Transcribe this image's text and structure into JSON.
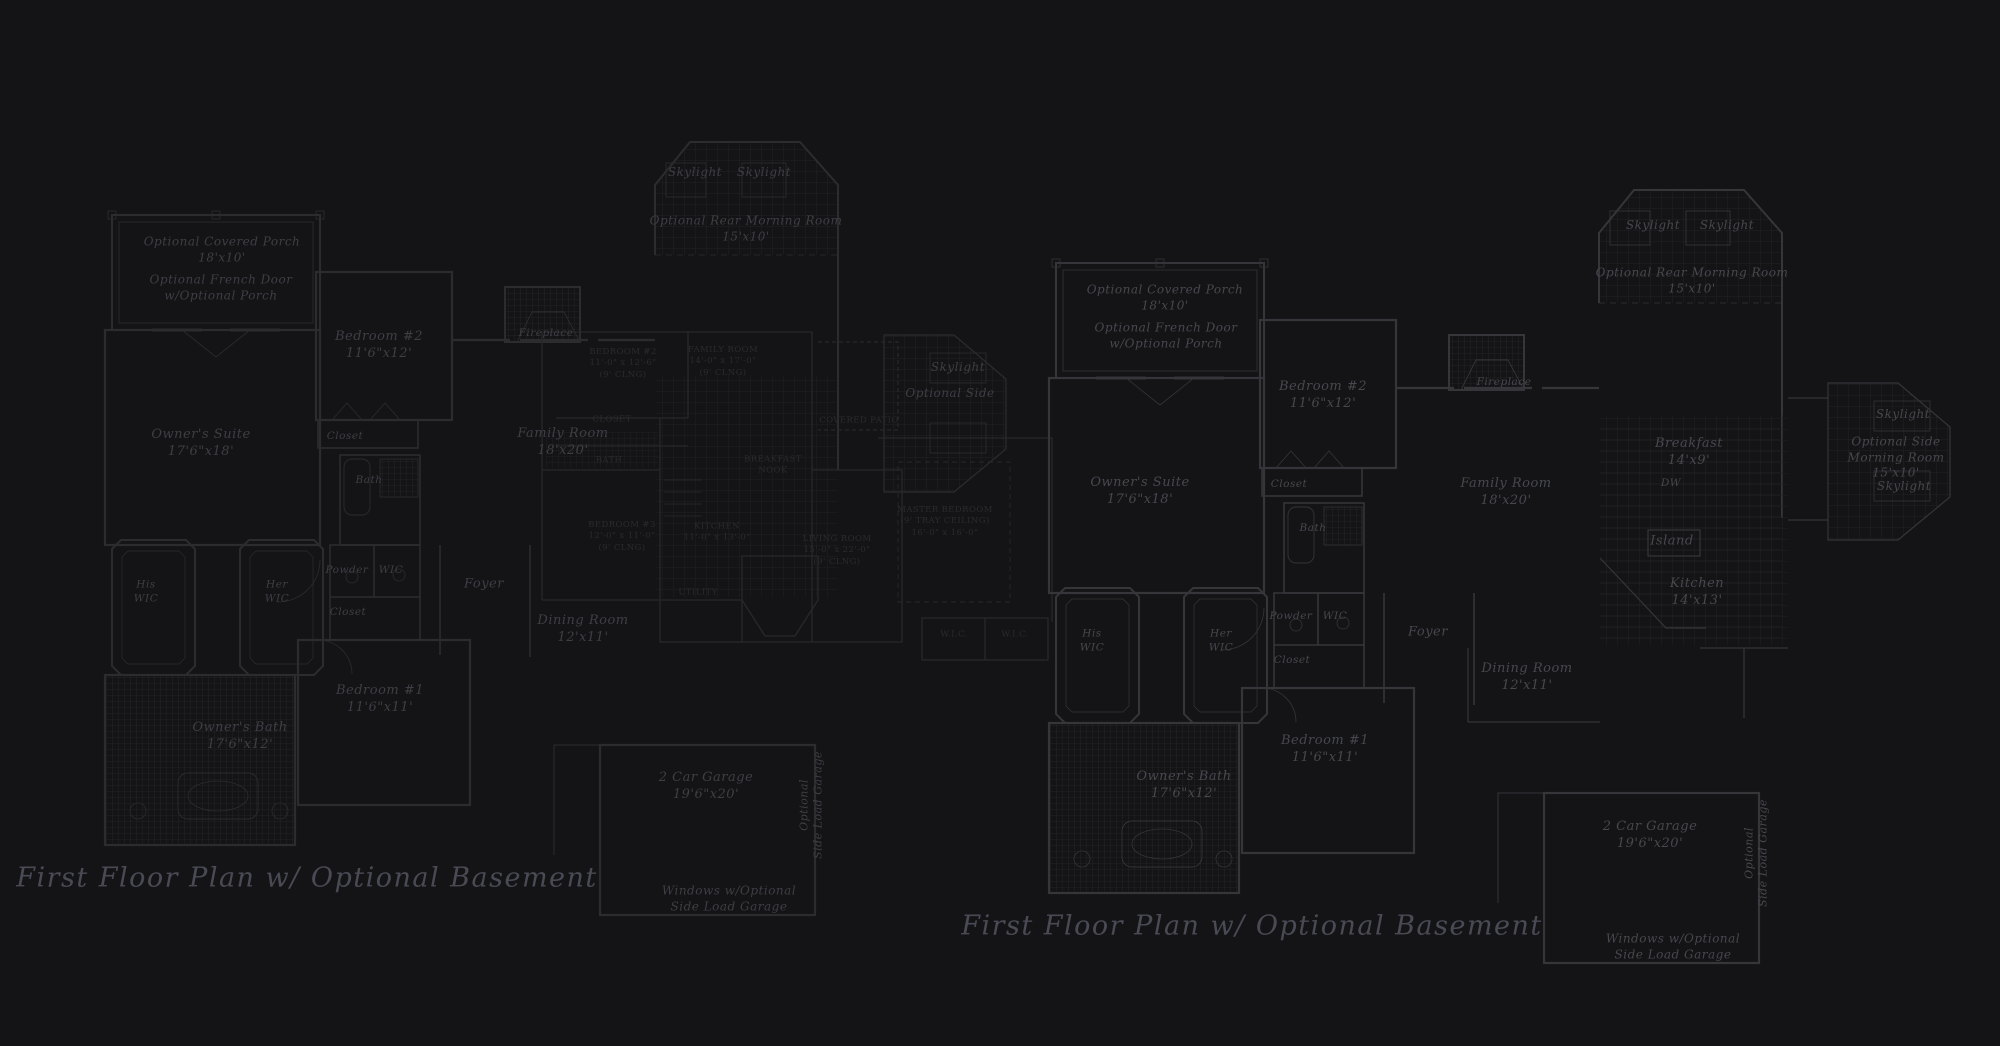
{
  "page": {
    "background": "#141416",
    "wall_color_left": "#2c2c2f",
    "wall_color_right": "#35353a",
    "overlay_wall_color": "#28282b",
    "grid_color": "#232327",
    "text_color_left": "#3e3e46",
    "text_color_right": "#47474f",
    "overlay_text_color": "#2b2b2f",
    "title_color": "#4a4a55"
  },
  "drawing_titles": {
    "left": "First Floor Plan  w/ Optional Basement",
    "right": "First Floor Plan  w/ Optional Basement"
  },
  "labels": [
    {
      "name": "left-skylight-1",
      "text": "Skylight",
      "x": 695,
      "y": 173,
      "kind": "note",
      "tone": "left"
    },
    {
      "name": "left-skylight-2",
      "text": "Skylight",
      "x": 764,
      "y": 173,
      "kind": "note",
      "tone": "left"
    },
    {
      "name": "left-rear-morning-room",
      "text": "Optional Rear Morning Room\n15'x10'",
      "x": 746,
      "y": 229,
      "kind": "note",
      "tone": "left"
    },
    {
      "name": "left-covered-porch",
      "text": "Optional Covered Porch\n18'x10'",
      "x": 222,
      "y": 250,
      "kind": "note",
      "tone": "left"
    },
    {
      "name": "left-french-door",
      "text": "Optional French Door\nw/Optional Porch",
      "x": 221,
      "y": 288,
      "kind": "note",
      "tone": "left"
    },
    {
      "name": "left-bedroom-2",
      "text": "Bedroom #2\n11'6\"x12'",
      "x": 379,
      "y": 346,
      "kind": "room",
      "tone": "left"
    },
    {
      "name": "left-closet-1",
      "text": "Closet",
      "x": 345,
      "y": 437,
      "kind": "small",
      "tone": "left"
    },
    {
      "name": "left-owners-suite",
      "text": "Owner's Suite\n17'6\"x18'",
      "x": 201,
      "y": 444,
      "kind": "room",
      "tone": "left"
    },
    {
      "name": "left-bath",
      "text": "Bath",
      "x": 369,
      "y": 481,
      "kind": "small",
      "tone": "left"
    },
    {
      "name": "left-fireplace",
      "text": "Fireplace",
      "x": 546,
      "y": 334,
      "kind": "small",
      "tone": "left"
    },
    {
      "name": "left-family-room",
      "text": "Family Room\n18'x20'",
      "x": 563,
      "y": 443,
      "kind": "room",
      "tone": "left"
    },
    {
      "name": "left-side-skylight",
      "text": "Skylight",
      "x": 958,
      "y": 368,
      "kind": "note",
      "tone": "left"
    },
    {
      "name": "left-side-morning-room",
      "text": "Optional Side",
      "x": 950,
      "y": 394,
      "kind": "note",
      "tone": "left"
    },
    {
      "name": "left-powder",
      "text": "Powder",
      "x": 347,
      "y": 571,
      "kind": "small",
      "tone": "left"
    },
    {
      "name": "left-wic",
      "text": "WIC",
      "x": 391,
      "y": 571,
      "kind": "small",
      "tone": "left"
    },
    {
      "name": "left-closet-2",
      "text": "Closet",
      "x": 348,
      "y": 613,
      "kind": "small",
      "tone": "left"
    },
    {
      "name": "left-his-wic",
      "text": "His\nWIC",
      "x": 146,
      "y": 592,
      "kind": "small",
      "tone": "left"
    },
    {
      "name": "left-her-wic",
      "text": "Her\nWIC",
      "x": 277,
      "y": 592,
      "kind": "small",
      "tone": "left"
    },
    {
      "name": "left-foyer",
      "text": "Foyer",
      "x": 484,
      "y": 585,
      "kind": "room",
      "tone": "left"
    },
    {
      "name": "left-dining-room",
      "text": "Dining Room\n12'x11'",
      "x": 583,
      "y": 630,
      "kind": "room",
      "tone": "left"
    },
    {
      "name": "left-bedroom-1",
      "text": "Bedroom #1\n11'6\"x11'",
      "x": 380,
      "y": 700,
      "kind": "room",
      "tone": "left"
    },
    {
      "name": "left-owners-bath",
      "text": "Owner's Bath\n17'6\"x12'",
      "x": 240,
      "y": 737,
      "kind": "room",
      "tone": "left"
    },
    {
      "name": "left-garage",
      "text": "2 Car Garage\n19'6\"x20'",
      "x": 706,
      "y": 787,
      "kind": "room",
      "tone": "left"
    },
    {
      "name": "left-side-load-garage",
      "text": "Optional\nSide Load Garage",
      "x": 812,
      "y": 805,
      "kind": "vert",
      "tone": "left"
    },
    {
      "name": "left-windows-note",
      "text": "Windows w/Optional\nSide Load Garage",
      "x": 729,
      "y": 899,
      "kind": "note",
      "tone": "left"
    },
    {
      "name": "left-plan-title",
      "text": "First Floor Plan  w/ Optional Basement",
      "x": 307,
      "y": 878,
      "kind": "title",
      "tone": "left"
    },
    {
      "name": "overlay-bedroom-2",
      "text": "BEDROOM #2\n11'-0\" x 12'-6\"\n(9' CLNG)",
      "x": 623,
      "y": 364,
      "kind": "caps",
      "tone": "overlay"
    },
    {
      "name": "overlay-family-room",
      "text": "FAMILY ROOM\n14'-0\" x 17'-0\"\n(9' CLNG)",
      "x": 723,
      "y": 362,
      "kind": "caps",
      "tone": "overlay"
    },
    {
      "name": "overlay-closet",
      "text": "CLOSET",
      "x": 612,
      "y": 420,
      "kind": "caps",
      "tone": "overlay"
    },
    {
      "name": "overlay-bath",
      "text": "BATH",
      "x": 609,
      "y": 461,
      "kind": "caps",
      "tone": "overlay"
    },
    {
      "name": "overlay-bedroom-3",
      "text": "BEDROOM #3\n12'-0\" x 11'-0\"\n(9' CLNG)",
      "x": 622,
      "y": 537,
      "kind": "caps",
      "tone": "overlay"
    },
    {
      "name": "overlay-kitchen",
      "text": "KITCHEN\n11'-0\" x 13'-0\"",
      "x": 717,
      "y": 533,
      "kind": "caps",
      "tone": "overlay"
    },
    {
      "name": "overlay-breakfast-nook",
      "text": "BREAKFAST\nNOOK",
      "x": 773,
      "y": 466,
      "kind": "caps",
      "tone": "overlay"
    },
    {
      "name": "overlay-utility",
      "text": "UTILITY",
      "x": 698,
      "y": 593,
      "kind": "caps",
      "tone": "overlay"
    },
    {
      "name": "overlay-living-room",
      "text": "LIVING ROOM\n15'-0\" x 22'-0\"\n(9' CLNG)",
      "x": 837,
      "y": 551,
      "kind": "caps",
      "tone": "overlay"
    },
    {
      "name": "overlay-covered-patio",
      "text": "COVERED PATIO",
      "x": 859,
      "y": 421,
      "kind": "caps",
      "tone": "overlay"
    },
    {
      "name": "overlay-master-bedroom",
      "text": "MASTER BEDROOM\n(9' TRAY CEILING)\n16'-0\" x 16'-0\"",
      "x": 945,
      "y": 522,
      "kind": "caps",
      "tone": "overlay"
    },
    {
      "name": "overlay-wic-1",
      "text": "W.I.C.",
      "x": 954,
      "y": 635,
      "kind": "caps",
      "tone": "overlay"
    },
    {
      "name": "overlay-wic-2",
      "text": "W.I.C.",
      "x": 1015,
      "y": 635,
      "kind": "caps",
      "tone": "overlay"
    },
    {
      "name": "right-skylight-1",
      "text": "Skylight",
      "x": 1653,
      "y": 226,
      "kind": "note",
      "tone": "right"
    },
    {
      "name": "right-skylight-2",
      "text": "Skylight",
      "x": 1727,
      "y": 226,
      "kind": "note",
      "tone": "right"
    },
    {
      "name": "right-rear-morning-room",
      "text": "Optional Rear Morning Room\n15'x10'",
      "x": 1692,
      "y": 281,
      "kind": "note",
      "tone": "right"
    },
    {
      "name": "right-covered-porch",
      "text": "Optional Covered Porch\n18'x10'",
      "x": 1165,
      "y": 298,
      "kind": "note",
      "tone": "right"
    },
    {
      "name": "right-french-door",
      "text": "Optional French Door\nw/Optional Porch",
      "x": 1166,
      "y": 336,
      "kind": "note",
      "tone": "right"
    },
    {
      "name": "right-bedroom-2",
      "text": "Bedroom #2\n11'6\"x12'",
      "x": 1323,
      "y": 396,
      "kind": "room",
      "tone": "right"
    },
    {
      "name": "right-closet-1",
      "text": "Closet",
      "x": 1289,
      "y": 485,
      "kind": "small",
      "tone": "right"
    },
    {
      "name": "right-owners-suite",
      "text": "Owner's Suite\n17'6\"x18'",
      "x": 1140,
      "y": 492,
      "kind": "room",
      "tone": "right"
    },
    {
      "name": "right-bath",
      "text": "Bath",
      "x": 1313,
      "y": 529,
      "kind": "small",
      "tone": "right"
    },
    {
      "name": "right-fireplace",
      "text": "Fireplace",
      "x": 1504,
      "y": 383,
      "kind": "small",
      "tone": "right"
    },
    {
      "name": "right-family-room",
      "text": "Family Room\n18'x20'",
      "x": 1506,
      "y": 493,
      "kind": "room",
      "tone": "right"
    },
    {
      "name": "right-breakfast",
      "text": "Breakfast\n14'x9'",
      "x": 1689,
      "y": 453,
      "kind": "room",
      "tone": "right"
    },
    {
      "name": "right-dw",
      "text": "DW",
      "x": 1671,
      "y": 484,
      "kind": "small",
      "tone": "right"
    },
    {
      "name": "right-island",
      "text": "Island",
      "x": 1672,
      "y": 542,
      "kind": "room",
      "tone": "right"
    },
    {
      "name": "right-kitchen",
      "text": "Kitchen\n14'x13'",
      "x": 1697,
      "y": 593,
      "kind": "room",
      "tone": "right"
    },
    {
      "name": "right-powder",
      "text": "Powder",
      "x": 1291,
      "y": 617,
      "kind": "small",
      "tone": "right"
    },
    {
      "name": "right-wic",
      "text": "WIC",
      "x": 1335,
      "y": 617,
      "kind": "small",
      "tone": "right"
    },
    {
      "name": "right-closet-2",
      "text": "Closet",
      "x": 1292,
      "y": 661,
      "kind": "small",
      "tone": "right"
    },
    {
      "name": "right-his-wic",
      "text": "His\nWIC",
      "x": 1092,
      "y": 641,
      "kind": "small",
      "tone": "right"
    },
    {
      "name": "right-her-wic",
      "text": "Her\nWIC",
      "x": 1221,
      "y": 641,
      "kind": "small",
      "tone": "right"
    },
    {
      "name": "right-foyer",
      "text": "Foyer",
      "x": 1428,
      "y": 633,
      "kind": "room",
      "tone": "right"
    },
    {
      "name": "right-dining-room",
      "text": "Dining Room\n12'x11'",
      "x": 1527,
      "y": 678,
      "kind": "room",
      "tone": "right"
    },
    {
      "name": "right-bedroom-1",
      "text": "Bedroom #1\n11'6\"x11'",
      "x": 1325,
      "y": 750,
      "kind": "room",
      "tone": "right"
    },
    {
      "name": "right-owners-bath",
      "text": "Owner's Bath\n17'6\"x12'",
      "x": 1184,
      "y": 786,
      "kind": "room",
      "tone": "right"
    },
    {
      "name": "right-garage",
      "text": "2 Car Garage\n19'6\"x20'",
      "x": 1650,
      "y": 836,
      "kind": "room",
      "tone": "right"
    },
    {
      "name": "right-side-load-garage",
      "text": "Optional\nSide Load Garage",
      "x": 1757,
      "y": 853,
      "kind": "vert",
      "tone": "right"
    },
    {
      "name": "right-windows-note",
      "text": "Windows w/Optional\nSide Load Garage",
      "x": 1673,
      "y": 947,
      "kind": "note",
      "tone": "right"
    },
    {
      "name": "right-side-skylight-1",
      "text": "Skylight",
      "x": 1903,
      "y": 415,
      "kind": "note",
      "tone": "right"
    },
    {
      "name": "right-side-morning-room",
      "text": "Optional Side\nMorning Room\n15'x10'",
      "x": 1896,
      "y": 458,
      "kind": "note",
      "tone": "right"
    },
    {
      "name": "right-side-skylight-2",
      "text": "Skylight",
      "x": 1904,
      "y": 487,
      "kind": "note",
      "tone": "right"
    },
    {
      "name": "right-plan-title",
      "text": "First Floor Plan  w/ Optional Basement",
      "x": 1252,
      "y": 926,
      "kind": "title",
      "tone": "right"
    }
  ]
}
